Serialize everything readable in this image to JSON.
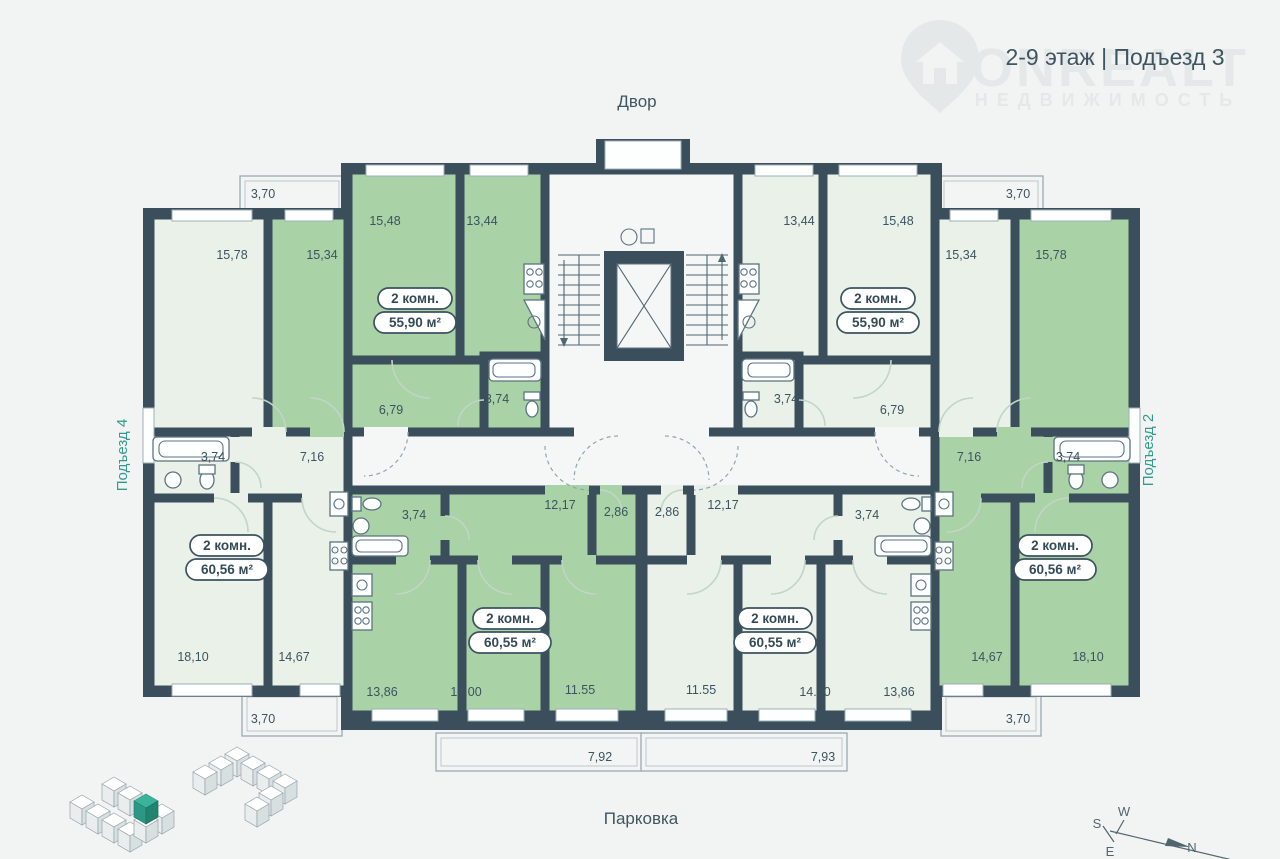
{
  "title": "2-9 этаж | Подъезд 3",
  "watermark": {
    "brand": "ONREALT",
    "sub": "НЕДВИЖИМОСТЬ"
  },
  "surroundings": {
    "top": "Двор",
    "bottom": "Парковка",
    "left": "Подъезд 4",
    "right": "Подъезд 2"
  },
  "apartments": {
    "two_room_5590": {
      "rooms": "2 комн.",
      "area": "55,90 м²"
    },
    "two_room_6056": {
      "rooms": "2 комн.",
      "area": "60,56 м²"
    },
    "two_room_6055": {
      "rooms": "2 комн.",
      "area": "60,55 м²"
    }
  },
  "dims": {
    "balcony_top": "3,70",
    "balcony_bottom": "3,70",
    "balcony_long_l": "7,92",
    "balcony_long_r": "7,93",
    "r1578": "15,78",
    "r1534": "15,34",
    "r1548": "15,48",
    "r1344": "13,44",
    "hall_upper": "6,79",
    "bath": "3,74",
    "hall_edge": "7,16",
    "corridor": "12,17",
    "wc": "2,86",
    "r1810": "18,10",
    "r1467": "14,67",
    "r1386": "13,86",
    "r1400": "14.00",
    "r1155": "11.55"
  },
  "compass": {
    "n": "N",
    "s": "S",
    "w": "W",
    "e": "E"
  },
  "colors": {
    "wall": "#3a4f5b",
    "room_highlight": "#a9d2a6",
    "room_pale": "#e9f1e9",
    "background": "#f2f4f3",
    "accent": "#2f9c8e",
    "text": "#3c5360",
    "minimap_highlight": "#3ab39b"
  }
}
